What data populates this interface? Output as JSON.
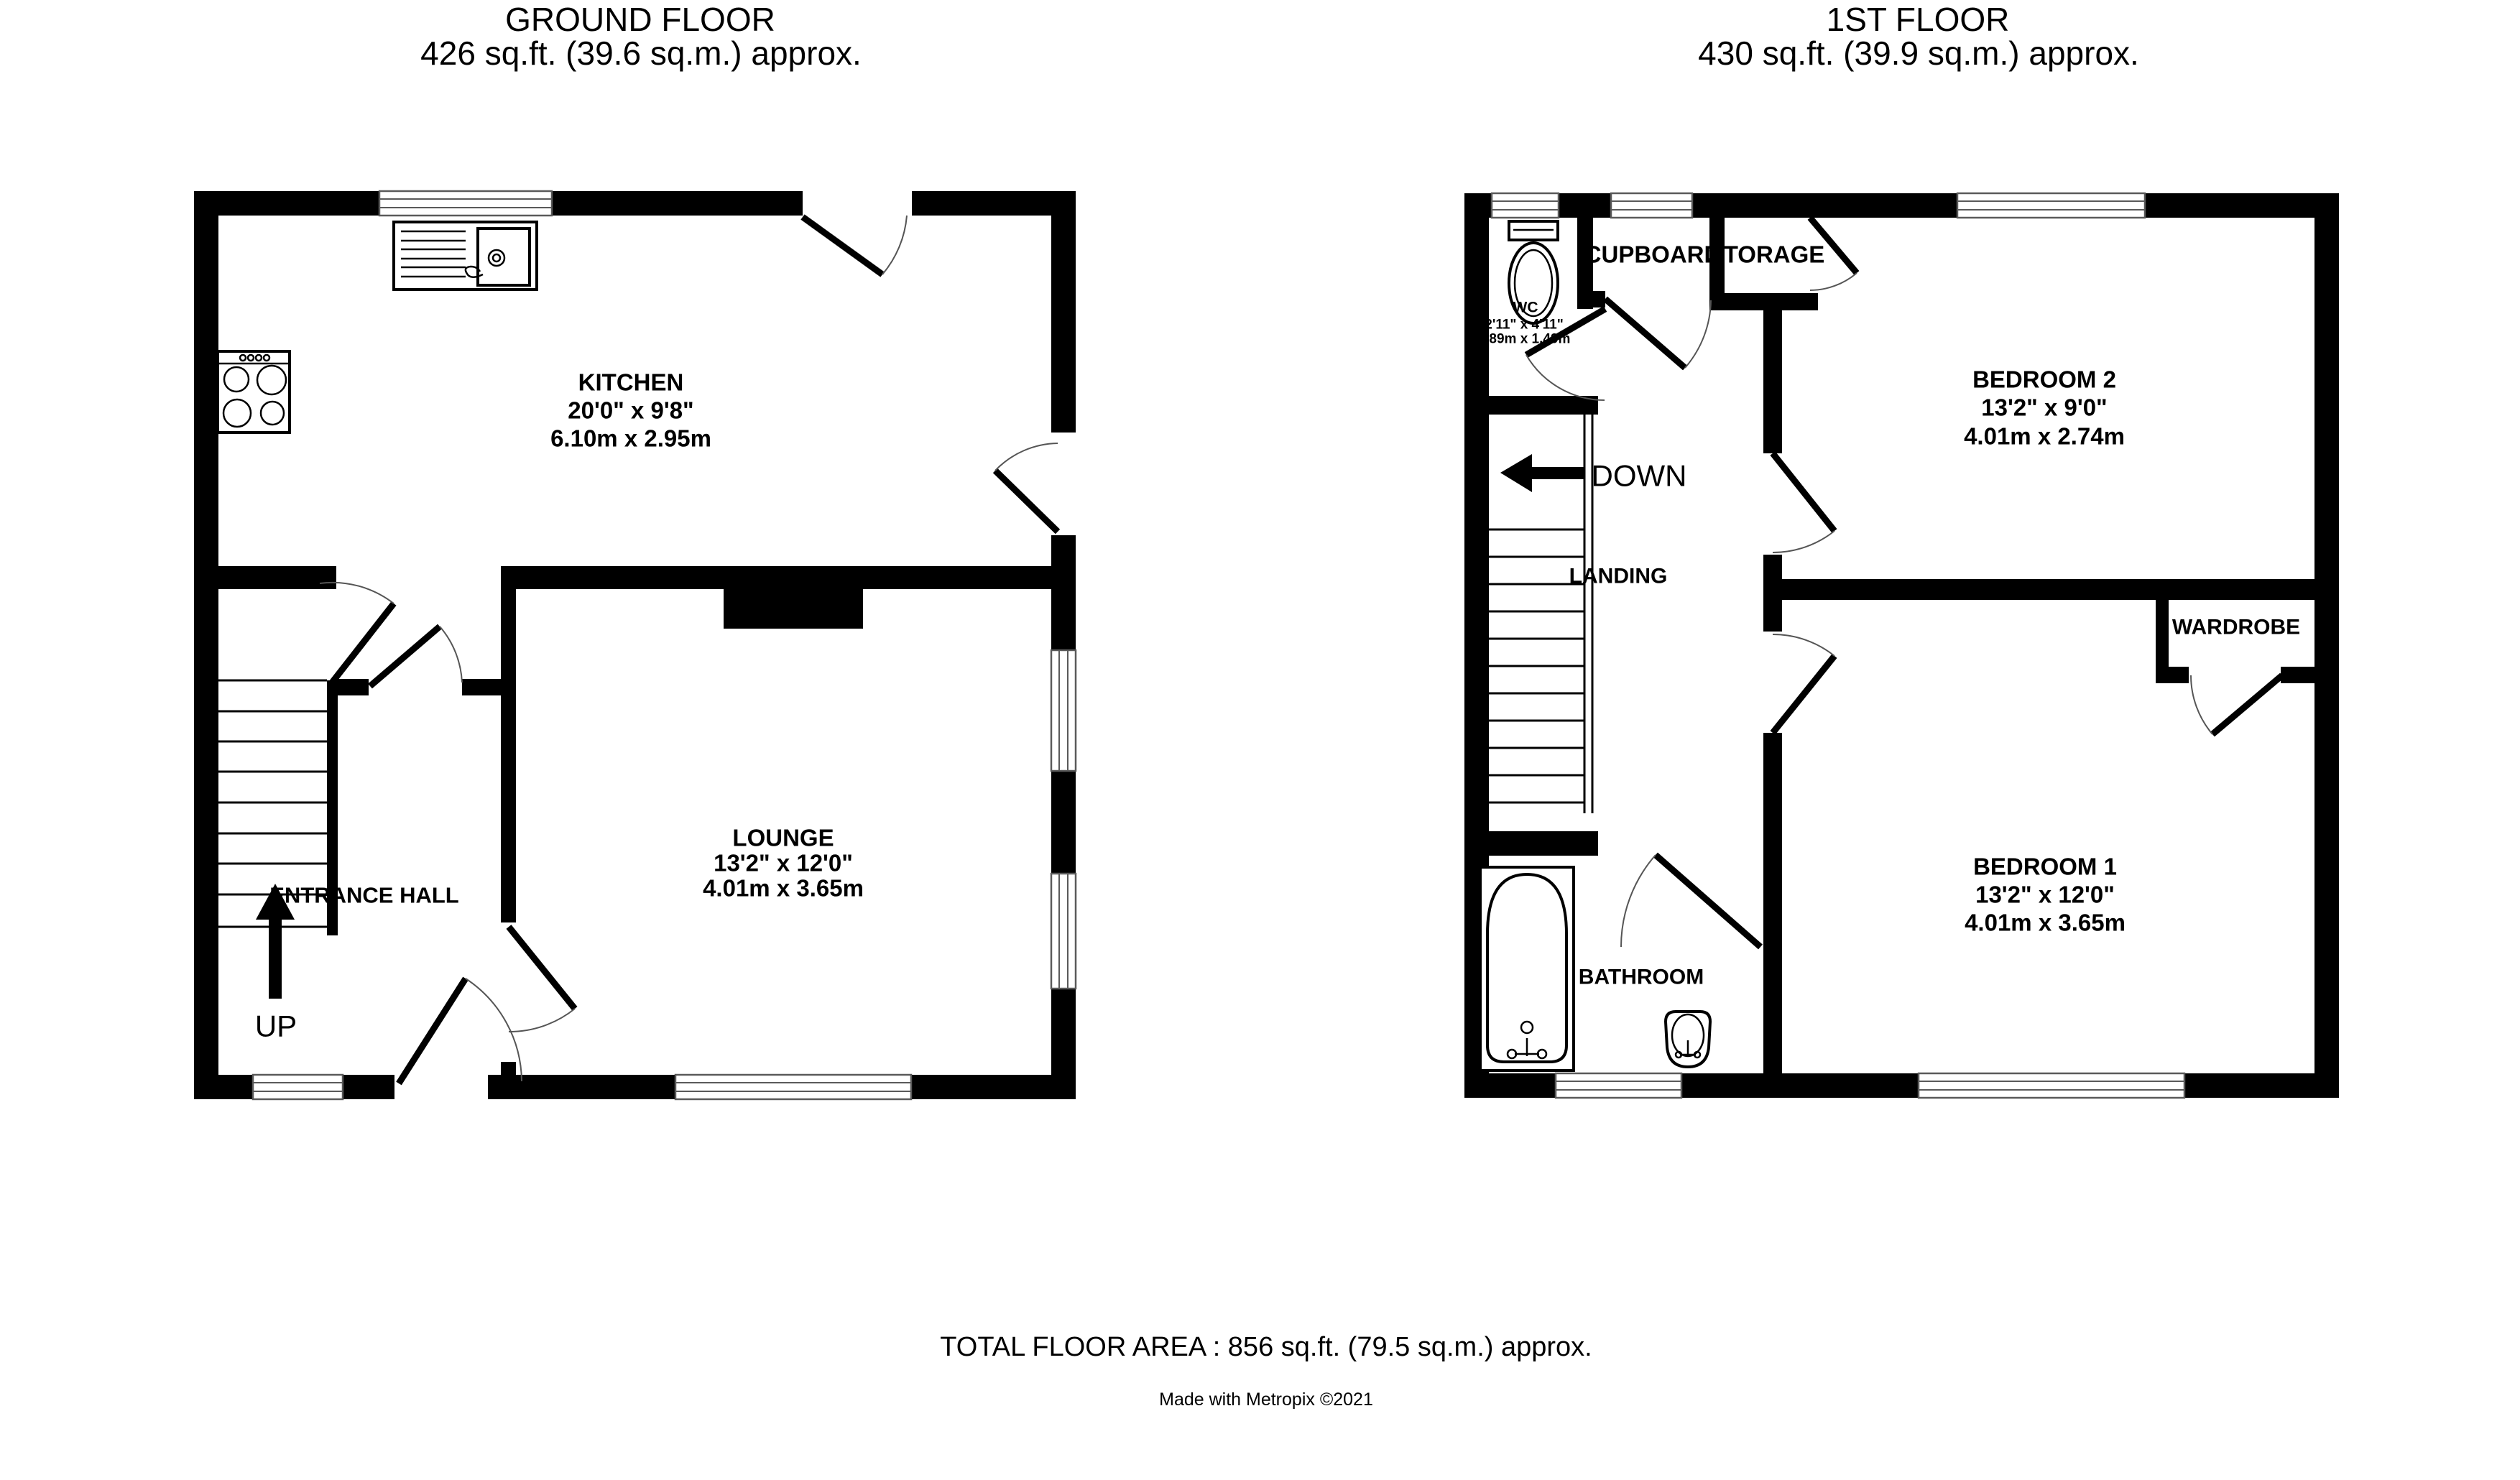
{
  "colors": {
    "wall": "#000000",
    "background": "#ffffff",
    "window-frame": "#5a5a5a",
    "door-arc": "#555555",
    "text": "#000000"
  },
  "ground_floor": {
    "title": "GROUND FLOOR",
    "subtitle": "426 sq.ft. (39.6 sq.m.) approx.",
    "stairs_label": "UP",
    "rooms": {
      "kitchen": {
        "name": "KITCHEN",
        "imperial": "20'0\"  x 9'8\"",
        "metric": "6.10m  x 2.95m"
      },
      "lounge": {
        "name": "LOUNGE",
        "imperial": "13'2\"  x 12'0\"",
        "metric": "4.01m  x 3.65m"
      },
      "entrance_hall": {
        "name": "ENTRANCE HALL"
      }
    }
  },
  "first_floor": {
    "title": "1ST FLOOR",
    "subtitle": "430 sq.ft. (39.9 sq.m.) approx.",
    "stairs_label": "DOWN",
    "rooms": {
      "wc": {
        "name": "WC",
        "imperial": "2'11\"  x 4'11\"",
        "metric": "0.89m  x 1.49m"
      },
      "cupboard": {
        "name": "CUPBOARD"
      },
      "storage": {
        "name": "STORAGE"
      },
      "bedroom2": {
        "name": "BEDROOM 2",
        "imperial": "13'2\"  x 9'0\"",
        "metric": "4.01m  x 2.74m"
      },
      "landing": {
        "name": "LANDING"
      },
      "wardrobe": {
        "name": "WARDROBE"
      },
      "bedroom1": {
        "name": "BEDROOM 1",
        "imperial": "13'2\"  x 12'0\"",
        "metric": "4.01m  x 3.65m"
      },
      "bathroom": {
        "name": "BATHROOM"
      }
    }
  },
  "footer": {
    "total_area": "TOTAL FLOOR AREA : 856 sq.ft. (79.5 sq.m.) approx.",
    "credit": "Made with Metropix ©2021"
  }
}
